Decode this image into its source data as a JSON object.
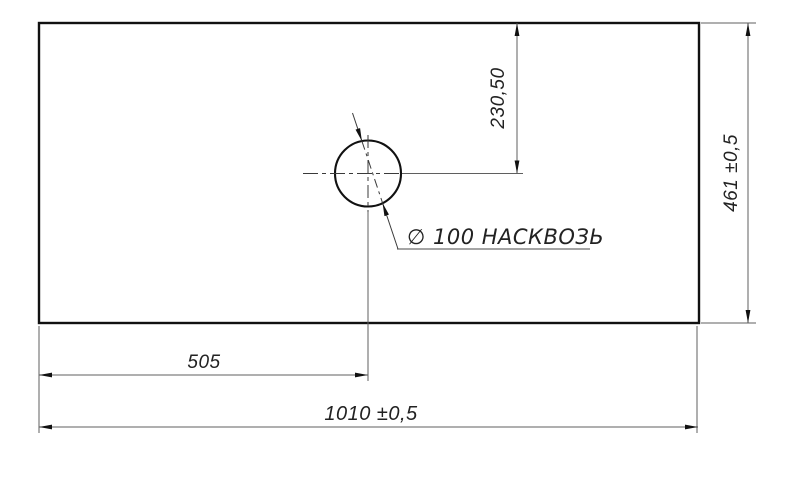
{
  "drawing": {
    "type": "technical-drawing",
    "view": "top-view-panel-with-hole",
    "hole_label": "∅ 100 НАСКВОЗЬ",
    "dims": {
      "hole_offset_top": "230,50",
      "panel_height": "461 ±0,5",
      "hole_offset_left": "505",
      "panel_width": "1010 ±0,5"
    },
    "colors": {
      "outline": "#111111",
      "thin_line": "#5f5f5f",
      "center_line": "#3a3a3a",
      "text": "#222222",
      "background": "#ffffff"
    }
  }
}
